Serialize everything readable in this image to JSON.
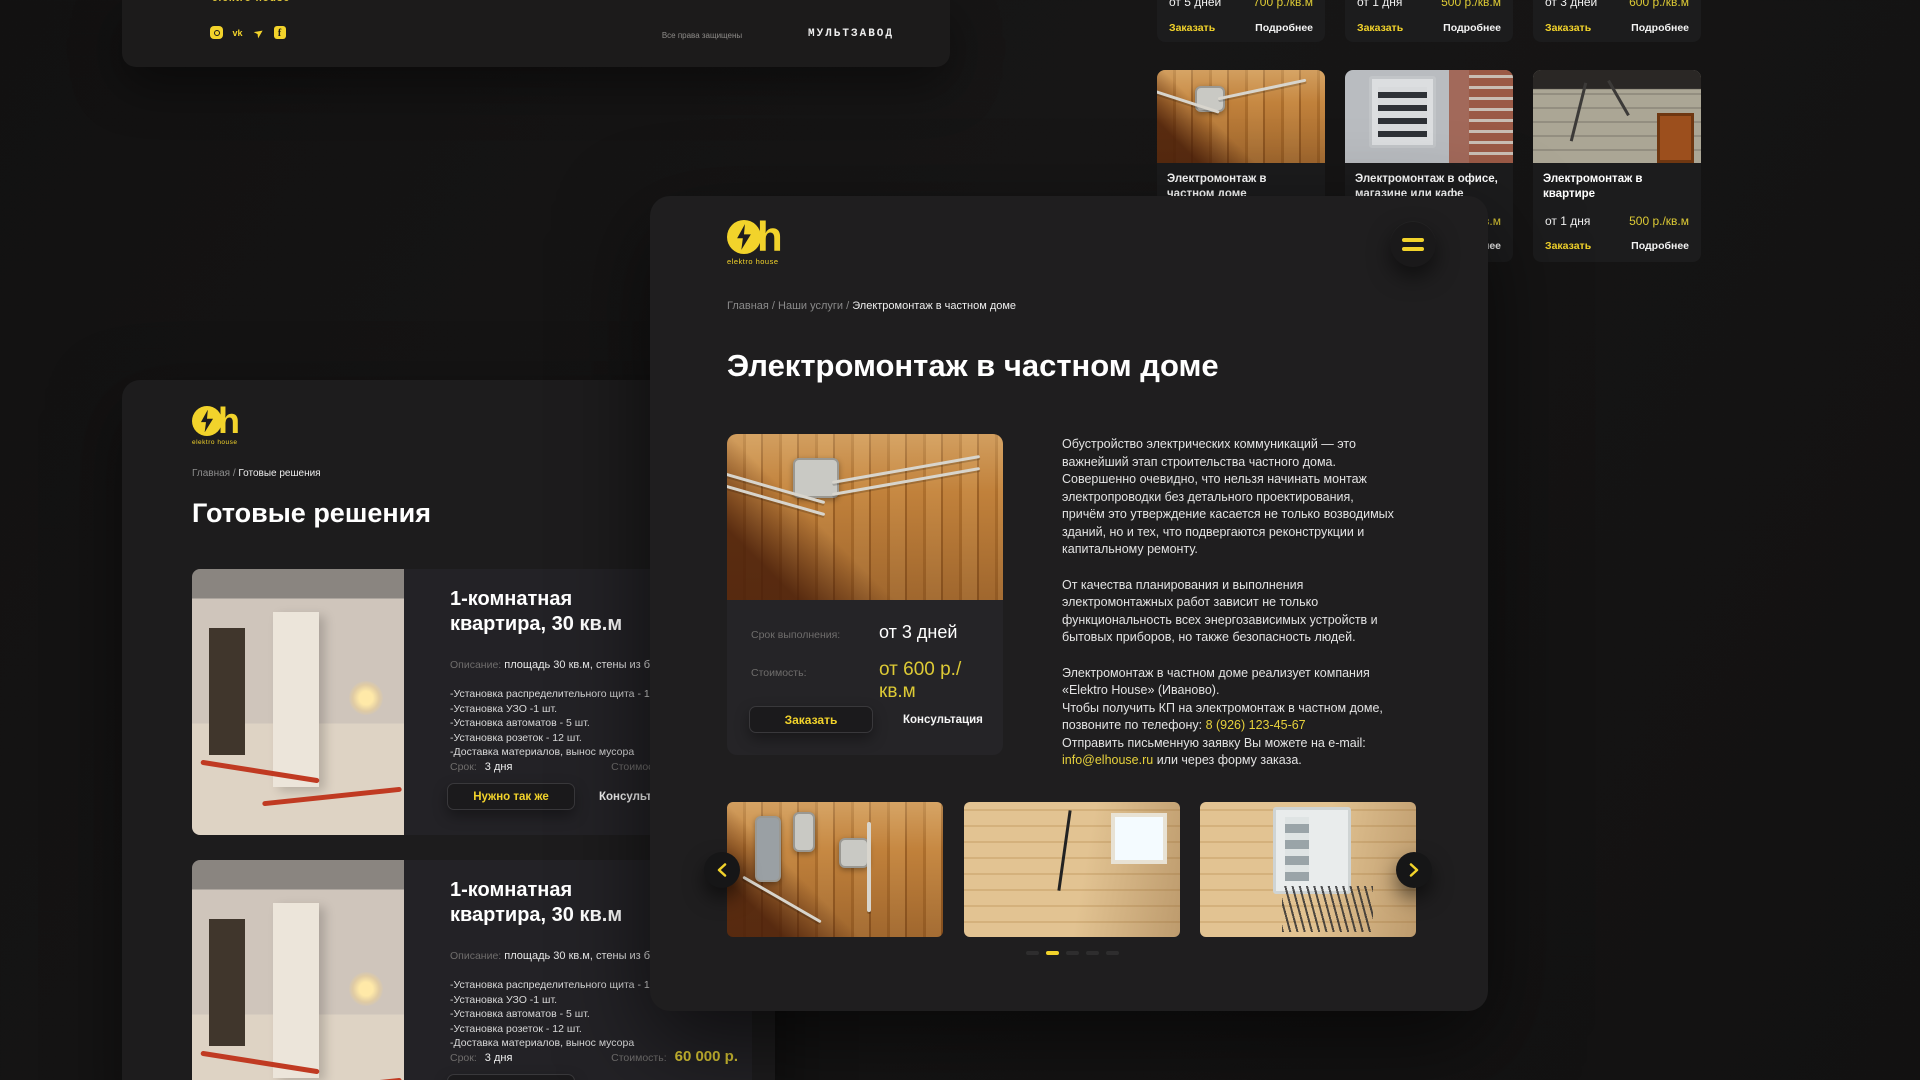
{
  "colors": {
    "accent": "#f2d32b",
    "price_yellow": "#ddca35",
    "bg": "#131212",
    "panel": "#1f1e1f"
  },
  "brand": {
    "logo_text": "elektro house"
  },
  "footer_bar": {
    "partial_logo": "elektro house",
    "copyright": "Все права защищены",
    "studio": "МУЛЬТЗАВОД",
    "social": [
      "instagram",
      "vk",
      "telegram",
      "facebook"
    ]
  },
  "services": {
    "order_label": "Заказать",
    "more_label": "Подробнее",
    "row1": [
      {
        "term": "от 5 дней",
        "price": "700 р./кв.м"
      },
      {
        "term": "от 1 дня",
        "price": "500 р./кв.м"
      },
      {
        "term": "от 3 дней",
        "price": "600 р./кв.м"
      }
    ],
    "row2": [
      {
        "title": "Электромонтаж в частном доме"
      },
      {
        "title": "Электромонтаж в офисе, магазине или кафе",
        "price": "500 р./кв.м"
      },
      {
        "title": "Электромонтаж в квартире",
        "term": "от 1 дня",
        "price": "500 р./кв.м"
      }
    ]
  },
  "solutions": {
    "breadcrumb_root": "Главная / ",
    "breadcrumb_current": "Готовые решения",
    "title": "Готовые решения",
    "cards": [
      {
        "title": "1-комнатная квартира, 30 кв.м",
        "desc_label": "Описание:",
        "desc": "площадь 30 кв.м, стены из бетона.",
        "features": [
          "-Установка распределительного щита - 1шт.",
          "-Установка УЗО -1 шт.",
          "-Установка автоматов - 5 шт.",
          "-Установка розеток - 12 шт.",
          "-Доставка материалов, вынос мусора"
        ],
        "term_label": "Срок:",
        "term": "3 дня",
        "price_label": "Стоимость:",
        "price": "60 000 р.",
        "order": "Нужно так же",
        "consult": "Консультация"
      },
      {
        "title": "1-комнатная квартира, 30 кв.м",
        "desc_label": "Описание:",
        "desc": "площадь 30 кв.м, стены из бетона.",
        "features": [
          "-Установка распределительного щита - 1шт.",
          "-Установка УЗО -1 шт.",
          "-Установка автоматов - 5 шт.",
          "-Установка розеток - 12 шт.",
          "-Доставка материалов, вынос мусора"
        ],
        "term_label": "Срок:",
        "term": "3 дня",
        "price_label": "Стоимость:",
        "price": "60 000 р.",
        "order": "Нужно так же",
        "consult": "Консультация"
      }
    ]
  },
  "service_page": {
    "breadcrumb_root": "Главная / Наши услуги / ",
    "breadcrumb_current": "Электромонтаж в частном доме",
    "title": "Электромонтаж в частном доме",
    "term_label": "Срок выполнения:",
    "term": "от 3 дней",
    "price_label": "Стоимость:",
    "price": "от 600 р./кв.м",
    "order": "Заказать",
    "consult": "Консультация",
    "p1": "Обустройство электрических коммуникаций — это важнейший этап строительства частного дома. Совершенно очевидно, что нельзя начинать монтаж электропроводки без детального проектирования, причём это утверждение касается не только возводимых зданий, но и тех, что подвергаются реконструкции и капитальному ремонту.",
    "p2": "От качества планирования и выполнения электромонтажных работ зависит не только функциональность всех энергозависимых устройств и бытовых приборов, но также безопасность людей.",
    "p3a": "Электромонтаж в частном доме реализует компания «Elektro House» (Иваново).",
    "p3b": "Чтобы получить КП на электромонтаж в частном доме, позвоните по телефону: ",
    "phone": "8 (926) 123-45-67",
    "p3c": "Отправить письменную заявку Вы можете на e-mail: ",
    "email": "info@elhouse.ru",
    "p3d": " или через форму заказа."
  }
}
